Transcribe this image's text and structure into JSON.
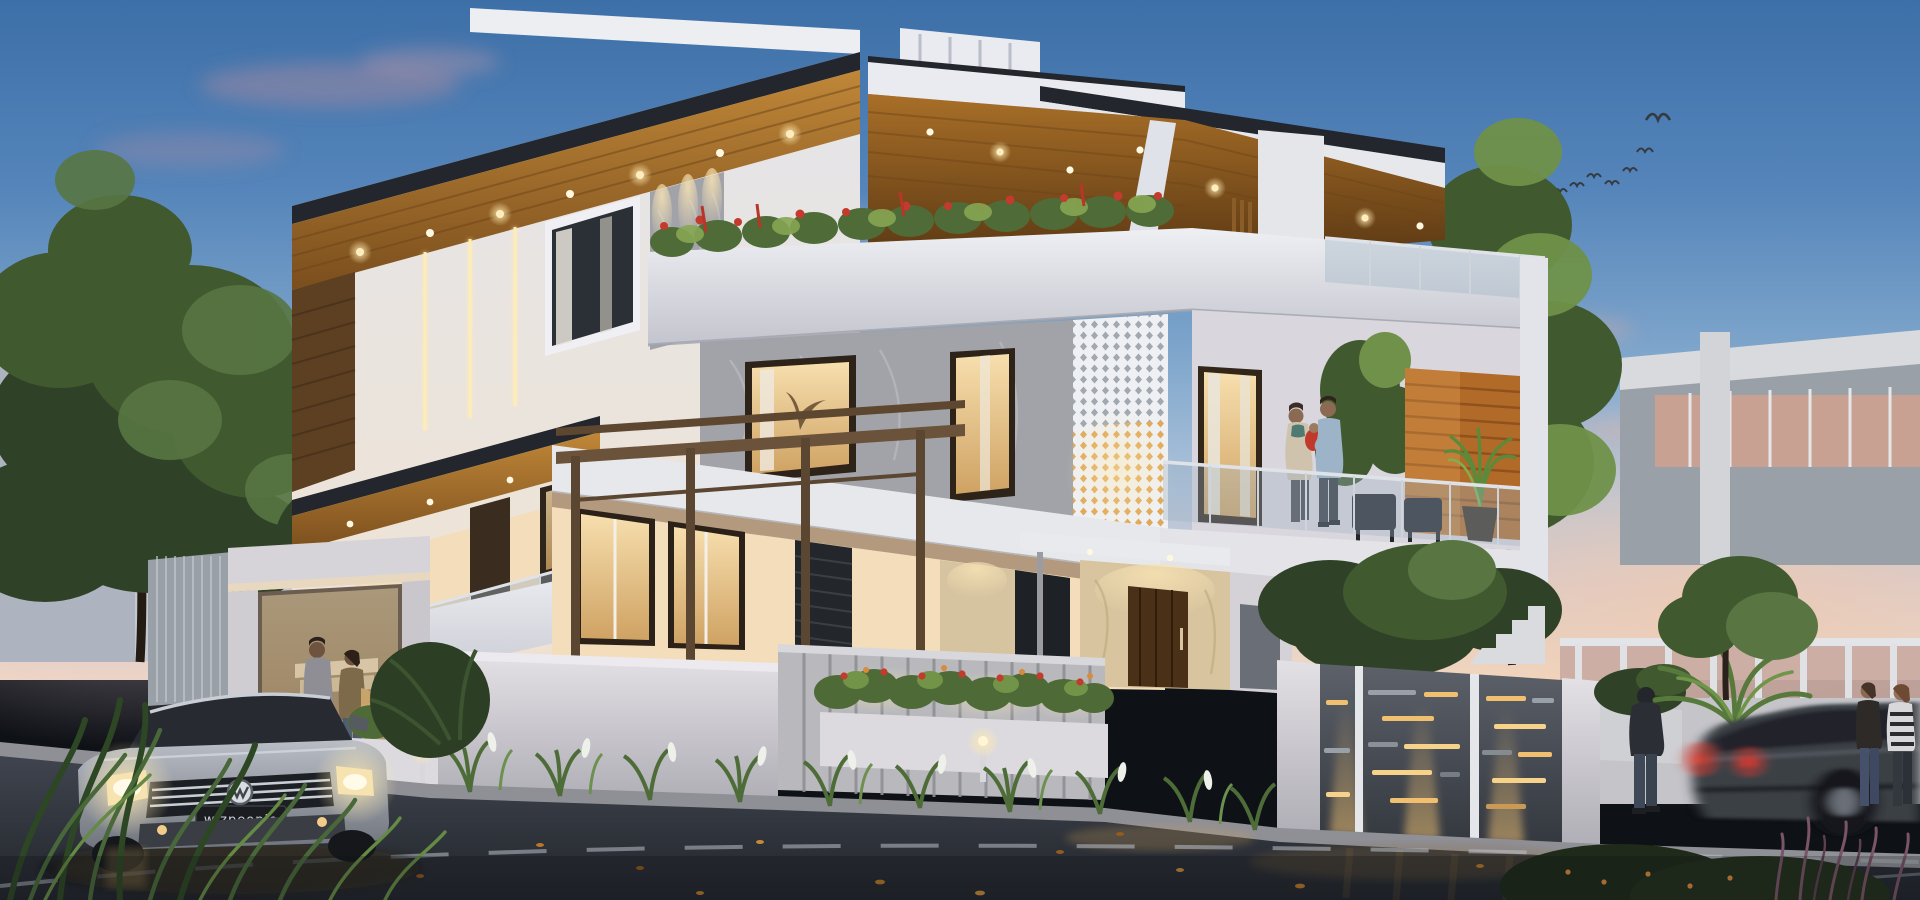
{
  "scene": {
    "description": "Photorealistic 3D exterior rendering of a modern multi-storey villa at dusk with landscape lighting, street, parked and moving cars, and people",
    "time_of_day": "dusk"
  },
  "palette": {
    "sky-top": "#3d6fa8",
    "sky-mid": "#7fa6cc",
    "sky-horizon": "#f2d9c2",
    "wall-white": "#e4e5ea",
    "wall-warm": "#f3ddba",
    "wood": "#b07a32",
    "wood-dark": "#7a4e1d",
    "fascia": "#23262c",
    "marble": "#a2a3a9",
    "glass": "#9fb2c2",
    "win-warm": "#f5d8a2",
    "led": "#ffedb8",
    "fol-dark": "#2f4227",
    "fol-mid": "#41592f",
    "fol-bright": "#6f9149",
    "flower": "#c23b2c",
    "road-top": "#3f444e",
    "road-bot": "#22252b",
    "lane": "#b9c0c8",
    "gate": "#4e535b",
    "slot-warm": "#f0c070",
    "pillar": "#b5b2ae",
    "cwall": "#d9d7db",
    "car-silver": "#a8adb5",
    "car-dark": "#3b3f45",
    "tail": "#d13a30",
    "head": "#ffe9b0"
  },
  "objects": {
    "birds": {
      "count": 7
    },
    "people": {
      "balcony_family": [
        "woman holding baby",
        "man in light blue shirt"
      ],
      "walking_couple": [
        "man in gray sweater",
        "woman with shoulder bag"
      ],
      "roadside": [
        "man in dark hoodie",
        "two women talking"
      ]
    },
    "vehicles": {
      "parked_car": {
        "type": "sedan",
        "brand_badge": "VW",
        "color": "silver",
        "headlights": "on",
        "plate": "wizpeople"
      },
      "moving_car": {
        "type": "sedan",
        "color": "dark gray",
        "motion": "blurred",
        "taillights": "on"
      }
    },
    "house": {
      "storeys": 3,
      "features": [
        "wood soffits with downlights",
        "glass railings",
        "perforated jali screen",
        "terrace planters with red flowers",
        "pergola",
        "slotted entry gate",
        "travertine entrance",
        "landscape uplighting"
      ]
    }
  }
}
